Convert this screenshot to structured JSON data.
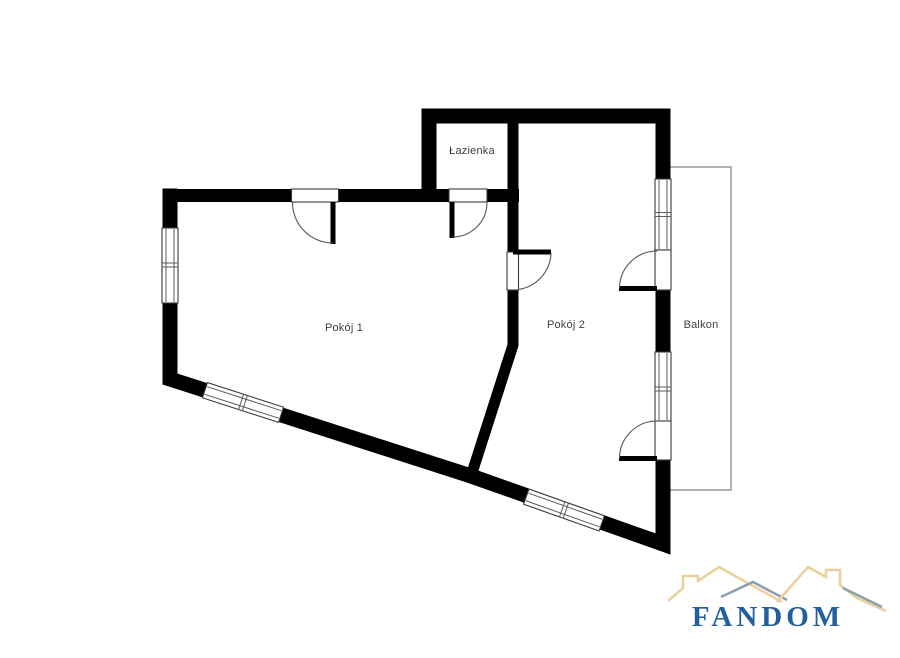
{
  "page": {
    "background": "#ffffff"
  },
  "floorplan": {
    "labels": {
      "bathroom": "Łazienka",
      "room1": "Pokój 1",
      "room2": "Pokój 2",
      "balcony": "Balkon"
    },
    "colors": {
      "wall": "#000000",
      "balcony_outline": "#a9a9a9",
      "opening_outline": "#3a3a3a",
      "label_text": "#3d3d3d"
    }
  },
  "logo": {
    "text": "FANDOM",
    "colors": {
      "text": "#235e9d",
      "roof_tan": "#ecd09b",
      "roof_slate": "#8ba1b2"
    }
  }
}
